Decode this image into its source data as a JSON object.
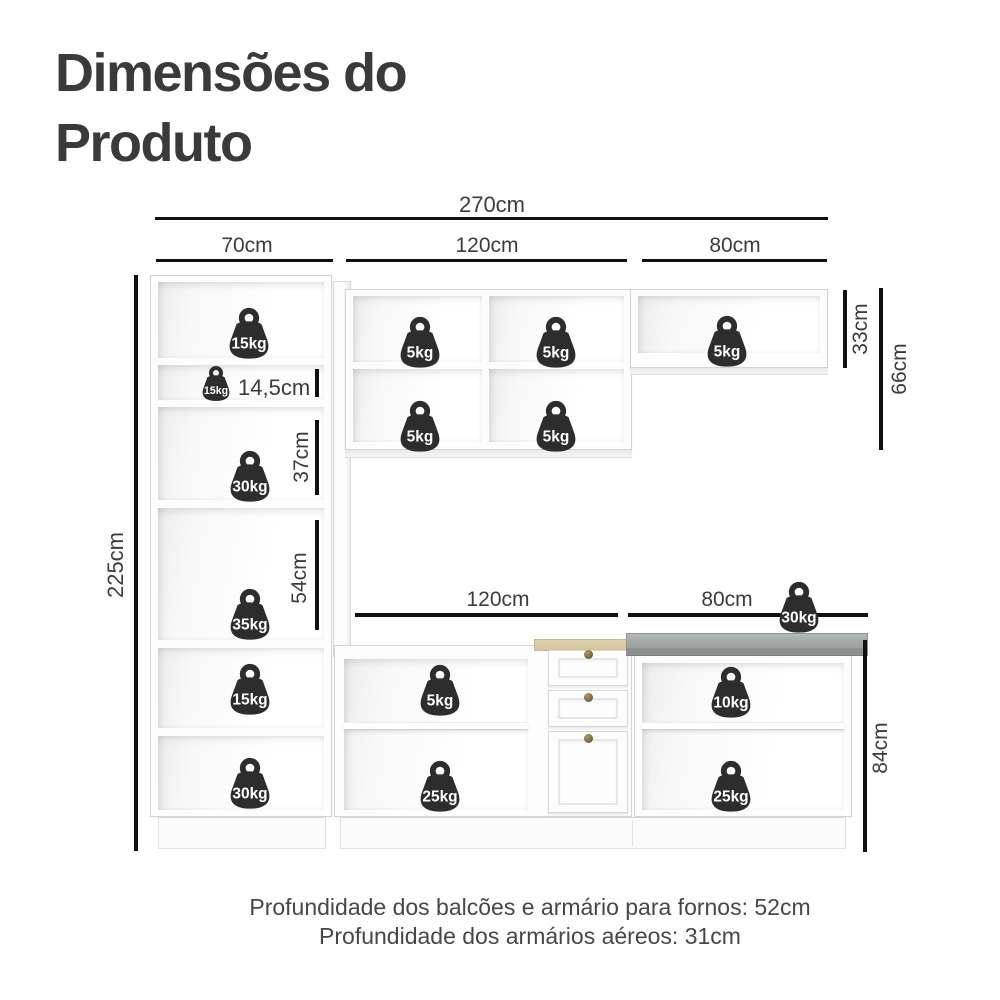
{
  "title": {
    "line1": "Dimensões do",
    "line2": "Produto"
  },
  "footer": {
    "line1": "Profundidade dos balcões e armário para fornos: 52cm",
    "line2": "Profundidade dos armários aéreos: 31cm"
  },
  "dims": {
    "width_total": "270cm",
    "width_left": "70cm",
    "width_middle": "120cm",
    "width_right": "80cm",
    "shelf_small_height": "14,5cm",
    "niche_mid_height": "37cm",
    "niche_large_height": "54cm",
    "height_total": "225cm",
    "wall_right_height": "33cm",
    "wall_height": "66cm",
    "base_middle_width": "120cm",
    "base_right_width": "80cm",
    "base_height": "84cm"
  },
  "weights": [
    {
      "label": "15kg",
      "x": 220,
      "y": 306,
      "size": "std",
      "location": "tall-cabinet-top"
    },
    {
      "label": "15kg",
      "x": 196,
      "y": 365,
      "size": "sm",
      "location": "tall-cabinet-small-shelf"
    },
    {
      "label": "30kg",
      "x": 221,
      "y": 449,
      "size": "std",
      "location": "tall-cabinet-niche-37"
    },
    {
      "label": "35kg",
      "x": 221,
      "y": 587,
      "size": "std",
      "location": "tall-cabinet-niche-54"
    },
    {
      "label": "15kg",
      "x": 221,
      "y": 662,
      "size": "std",
      "location": "tall-cabinet-lower"
    },
    {
      "label": "30kg",
      "x": 221,
      "y": 756,
      "size": "std",
      "location": "tall-cabinet-bottom"
    },
    {
      "label": "5kg",
      "x": 391,
      "y": 315,
      "size": "std",
      "location": "wall-cabinet-middle-r1c1"
    },
    {
      "label": "5kg",
      "x": 527,
      "y": 315,
      "size": "std",
      "location": "wall-cabinet-middle-r1c2"
    },
    {
      "label": "5kg",
      "x": 391,
      "y": 399,
      "size": "std",
      "location": "wall-cabinet-middle-r2c1"
    },
    {
      "label": "5kg",
      "x": 527,
      "y": 399,
      "size": "std",
      "location": "wall-cabinet-middle-r2c2"
    },
    {
      "label": "5kg",
      "x": 698,
      "y": 314,
      "size": "std",
      "location": "wall-cabinet-right"
    },
    {
      "label": "30kg",
      "x": 770,
      "y": 580,
      "size": "std",
      "location": "countertop"
    },
    {
      "label": "5kg",
      "x": 411,
      "y": 663,
      "size": "std",
      "location": "base-cabinet-middle-top"
    },
    {
      "label": "25kg",
      "x": 411,
      "y": 759,
      "size": "std",
      "location": "base-cabinet-middle-bottom"
    },
    {
      "label": "10kg",
      "x": 702,
      "y": 665,
      "size": "std",
      "location": "base-cabinet-right-top"
    },
    {
      "label": "25kg",
      "x": 702,
      "y": 759,
      "size": "std",
      "location": "base-cabinet-right-bottom"
    }
  ],
  "colors": {
    "weight": "#2d2d2d",
    "dimension_line": "#101010",
    "text": "#3c3c3c",
    "cabinet_edge": "#d4d4d4",
    "countertop": "#a3a7a6",
    "drawer_top_wood": "#d8cba6",
    "knob": "#7c6c41"
  }
}
